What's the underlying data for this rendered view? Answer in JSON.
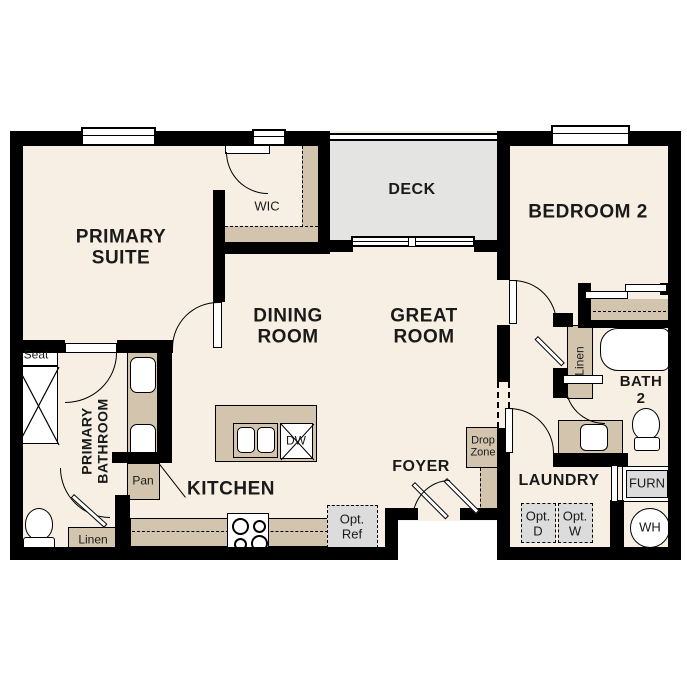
{
  "floorplan": {
    "rooms": {
      "primary_suite": [
        "PRIMARY",
        "SUITE"
      ],
      "wic": "WIC",
      "deck": "DECK",
      "bedroom2": "BEDROOM 2",
      "dining_room": [
        "DINING",
        "ROOM"
      ],
      "great_room": [
        "GREAT",
        "ROOM"
      ],
      "bath2": [
        "BATH",
        "2"
      ],
      "primary_bathroom": [
        "PRIMARY",
        "BATHROOM"
      ],
      "kitchen": "KITCHEN",
      "foyer": "FOYER",
      "laundry": "LAUNDRY"
    },
    "features": {
      "seat": "Seat",
      "linen_bathroom": "Linen",
      "linen_hall": "Linen",
      "pantry": "Pan",
      "drop_zone": [
        "Drop",
        "Zone"
      ],
      "optional_refrigerator": [
        "Opt.",
        "Ref"
      ],
      "optional_dryer": [
        "Opt.",
        "D"
      ],
      "optional_washer": [
        "Opt.",
        "W"
      ],
      "furnace": "FURN",
      "water_heater": "WH",
      "dishwasher": "DW"
    },
    "colors": {
      "wall": "#000000",
      "floor": "#f7efe3",
      "cabinetry": "#d3c5ad",
      "deck": "#e4e4e2",
      "plumbing_fixture": "#a9cce8",
      "optional_item": "#dcdcdc"
    }
  }
}
